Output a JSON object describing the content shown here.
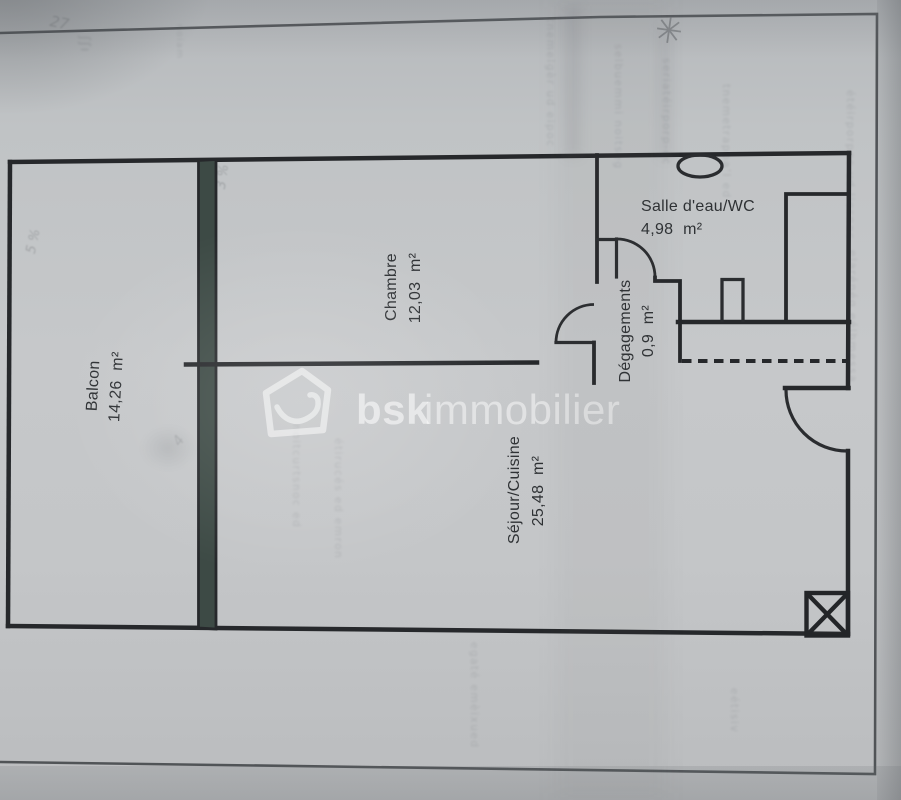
{
  "floor_plan": {
    "watermark": {
      "brand_bold": "bsk",
      "brand_light": "immobilier"
    },
    "rooms": {
      "balcon": {
        "name": "Balcon",
        "area": "14,26 m²"
      },
      "chambre": {
        "name": "Chambre",
        "area": "12,03 m²"
      },
      "sejour": {
        "name": "Séjour/Cuisine",
        "area": "25,48 m²"
      },
      "salle_eau": {
        "name": "Salle d'eau/WC",
        "area": "4,98 m²"
      },
      "degagements": {
        "name": "Dégagements",
        "area": "0,9 m²"
      }
    },
    "colors": {
      "wall_ink": "#26282b",
      "window_wall_fill": "#3d4a45",
      "paper": "#c3c6c8",
      "label_ink": "#2e3134",
      "watermark": "rgba(255,255,255,0.55)"
    },
    "ghost_bleedthrough": {
      "g1": "tnemelgèr ud eipoc",
      "g2": "selbuemmi noitseg",
      "g3": "seriatéirporp-oc",
      "g4": "tnemetrappa'l ed",
      "g5": "étéirporpoc ud liesnoc",
      "g6": "elarénég eélbmessa",
      "g7": "noitcurtsnoc ed",
      "g8": "étirucés ed emron",
      "g9": "egaté emèixued",
      "g10": "eétisiv",
      "g11": "noiam",
      "g12": "ʃʃı",
      "h1": "27",
      "h2": "5 %",
      "h3": "3 %",
      "h4": "4"
    }
  }
}
